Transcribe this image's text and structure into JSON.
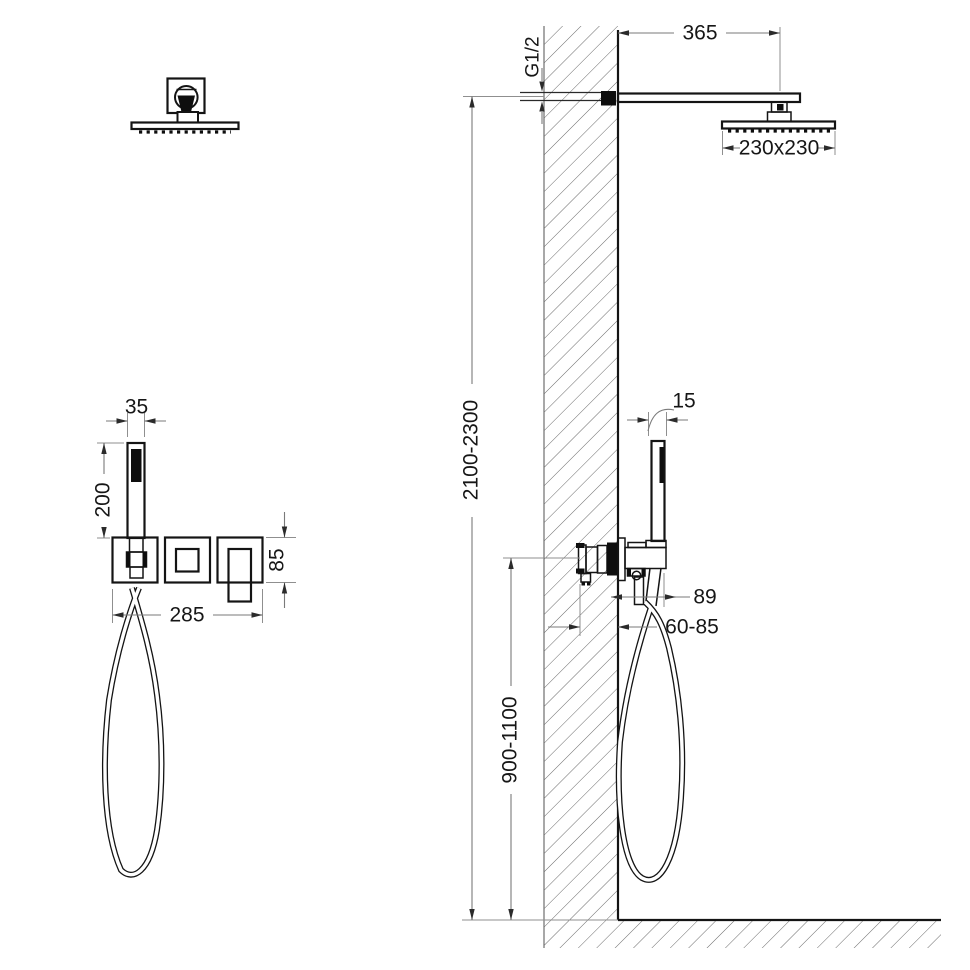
{
  "meta": {
    "drawing_type": "shower-system-installation-diagram",
    "background": "#ffffff",
    "line_color": "#141414",
    "dimension_line_color": "#7a7a7a"
  },
  "labels": {
    "arm_length": "365",
    "inlet_thread": "G1/2",
    "head_size": "230x230",
    "hand_shower_width": "35",
    "hand_shower_length": "200",
    "trim_plate_height": "85",
    "trim_width": "285",
    "hand_shower_depth": "15",
    "holder_projection": "89",
    "embed_depth": "60-85",
    "overhead_height_range": "2100-2300",
    "mixer_height_range": "900-1100"
  }
}
